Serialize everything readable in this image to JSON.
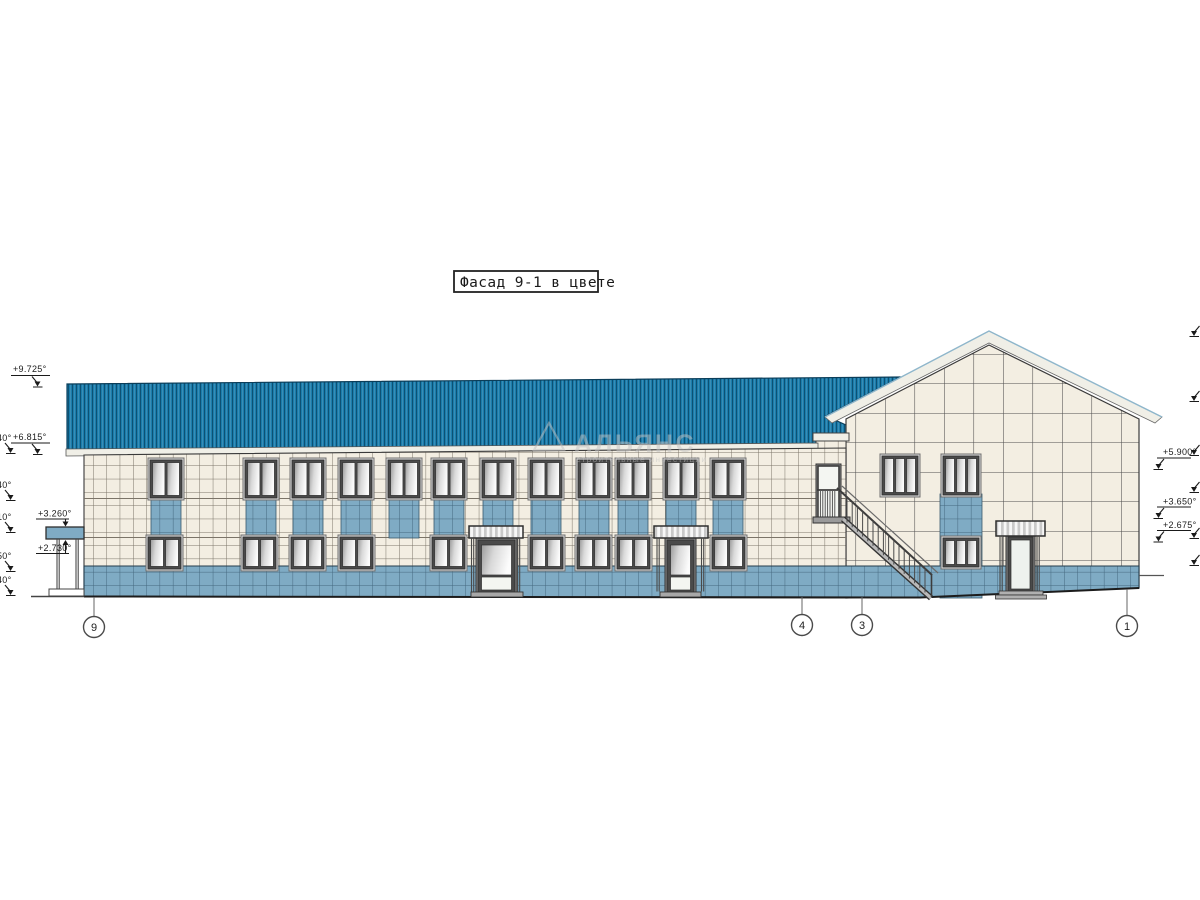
{
  "title": {
    "label": "Фасад 9-1 в цвете"
  },
  "watermark": {
    "logo": "triangle-logo-icon",
    "line1": "АЛЬЯНС",
    "line2": "строительные инвестиции"
  },
  "elevation_marks": {
    "left": [
      {
        "label": "+9.725°"
      },
      {
        "label": "+6.815°"
      },
      {
        "label": "+3.260°"
      },
      {
        "label": "+2.730°"
      }
    ],
    "left_clipped": [
      {
        "label": "40°"
      },
      {
        "label": "40°"
      },
      {
        "label": "10°"
      },
      {
        "label": "50°"
      },
      {
        "label": "40°"
      }
    ],
    "right": [
      {
        "label": "+5.900°"
      },
      {
        "label": "+3.650°"
      },
      {
        "label": "+2.675°"
      }
    ]
  },
  "axes": [
    {
      "label": "9"
    },
    {
      "label": "4"
    },
    {
      "label": "3"
    },
    {
      "label": "1"
    }
  ],
  "building": {
    "upper_window_x": [
      150,
      245,
      292,
      340,
      388,
      433,
      482,
      530,
      578,
      617,
      665,
      712
    ],
    "lower_window_x": [
      148,
      243,
      291,
      340,
      432,
      530,
      577,
      617,
      712
    ],
    "door_x": [
      478,
      667
    ],
    "gable_upper_window_x": [
      882,
      943
    ],
    "gable_lower_window_x": [
      943
    ]
  },
  "colors": {
    "roof": "#1a7dac",
    "roof_stripe": "#0d5174",
    "roof_highlight": "#4794bb",
    "roof_edge": "#0b3e5a",
    "fascia": "#f0efe7",
    "wall": "#f3eee2",
    "wall_line": "#7b7468",
    "gable_line": "#4f4f4f",
    "panel_blue": "#7fabc4",
    "panel_line": "#44687e",
    "frame_dark": "#4a4a4a",
    "frame_light": "#d8d8d8",
    "canopy_stripe": "#c9c9c9",
    "line_dark": "#2e2e2e",
    "text": "#1a1a1a",
    "watermark": "#c3c3c3",
    "band_accent": "#8fb7cc"
  }
}
